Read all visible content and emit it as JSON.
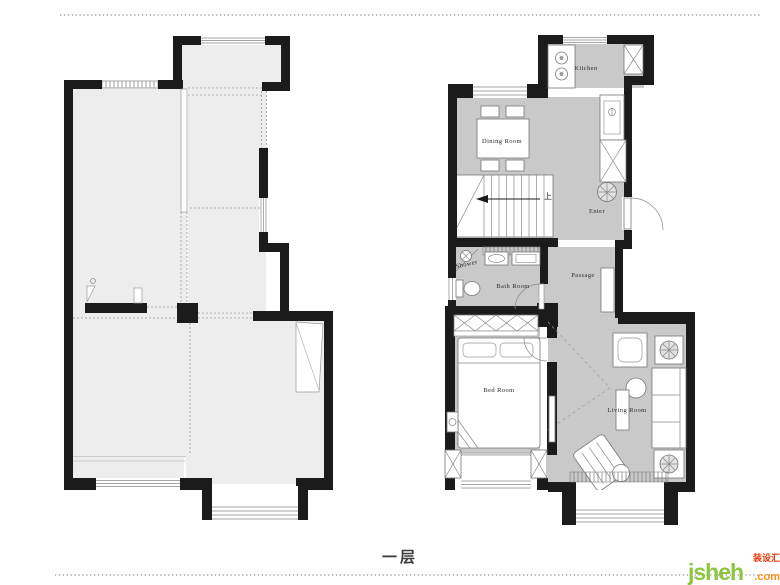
{
  "caption": "一层",
  "watermark": {
    "brand": "jsheh",
    "domain": ".com",
    "badge": "装设汇"
  },
  "rooms": {
    "kitchen": "Kitchen",
    "dining": "Dining Room",
    "stairs_up": "上",
    "enter": "Enter",
    "shower": "Shower",
    "bath": "Bath Room",
    "passage": "Passage",
    "bed": "Bed Room",
    "living": "Living Room"
  },
  "palette": {
    "wall": "#1b1b1b",
    "floor_original_plan": "#ededed",
    "floor_furnished_plan": "#c9c9c9",
    "detail_line": "#888888",
    "brand_green": "#8cc63e",
    "brand_orange": "#f6921e",
    "brand_red": "#e8380d"
  }
}
